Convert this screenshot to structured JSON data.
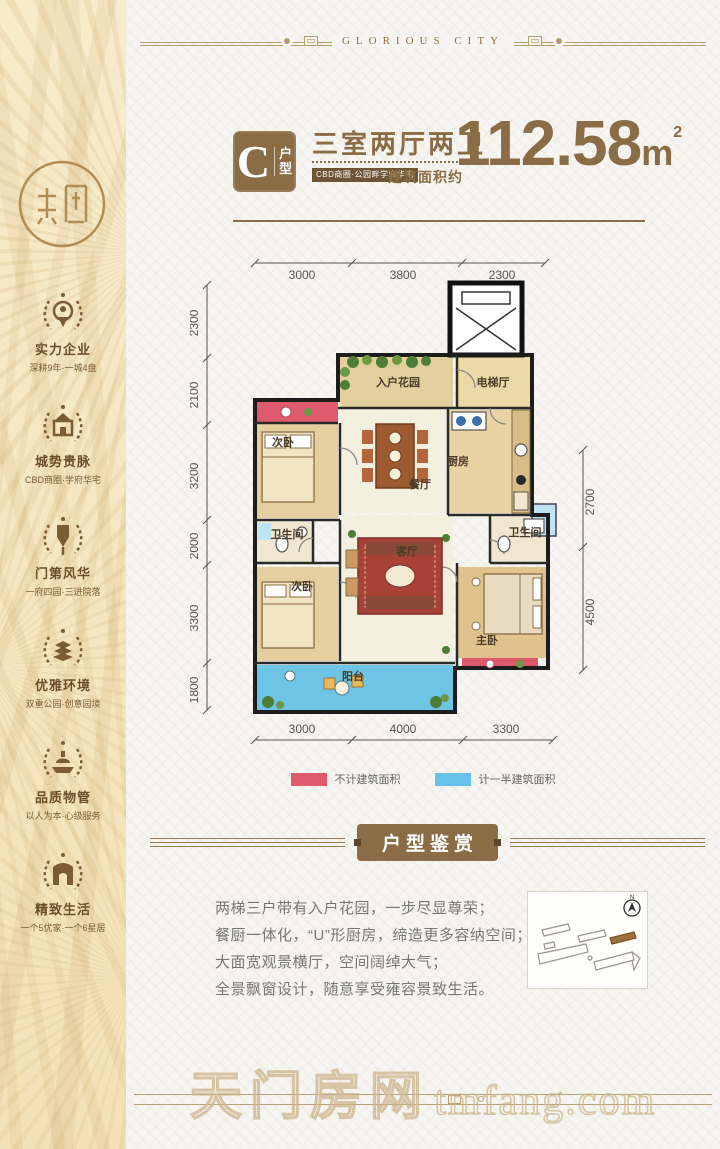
{
  "banner": {
    "text": "GLORIOUS CITY"
  },
  "sidebar": {
    "badges": [
      {
        "title": "实力企业",
        "subtitle": "深耕9年·一城4盘"
      },
      {
        "title": "城势贵脉",
        "subtitle": "CBD商圈·学府华宅"
      },
      {
        "title": "门第风华",
        "subtitle": "一府四园·三进院落"
      },
      {
        "title": "优雅环境",
        "subtitle": "双重公园·创意园境"
      },
      {
        "title": "品质物管",
        "subtitle": "以人为本·心级服务"
      },
      {
        "title": "精致生活",
        "subtitle": "一个5优家·一个6星居"
      }
    ]
  },
  "title_block": {
    "unit_letter": "C",
    "unit_label_1": "户",
    "unit_label_2": "型",
    "layout_name": "三室两厅两卫",
    "tagline": "CBD商圈·公园畔学府华宅",
    "area_prefix": "建筑面积约",
    "area_value": "112.58",
    "area_unit": "m",
    "area_exp": "2"
  },
  "floorplan": {
    "rooms": {
      "garden": "入户花园",
      "elevator_hall": "电梯厅",
      "kitchen": "厨房",
      "bedroom2": "次卧",
      "dining": "餐厅",
      "bath1": "卫生间",
      "living": "客厅",
      "bedroom3": "次卧",
      "bath2": "卫生间",
      "master": "主卧",
      "balcony": "阳台"
    },
    "dims_top": [
      "3000",
      "3800",
      "2300"
    ],
    "dims_left": [
      "2300",
      "2100",
      "3200",
      "2000",
      "3300",
      "1800"
    ],
    "dims_right": [
      "2700",
      "4500"
    ],
    "dims_bottom": [
      "3000",
      "4000",
      "3300"
    ]
  },
  "legend": {
    "red": "#e05a6d",
    "blue": "#66c2e8",
    "red_label": "不计建筑面积",
    "blue_label": "计一半建筑面积"
  },
  "section_title": "户型鉴赏",
  "description": [
    "两梯三户带有入户花园，一步尽显尊荣；",
    "餐厨一体化，“U”形厨房，缔造更多容纳空间；",
    "大面宽观景横厅，空间阔绰大气；",
    "全景飘窗设计，随意享受雍容景致生活。"
  ],
  "watermark": {
    "cn": "天门房网",
    "en": "tmfang.com"
  },
  "colors": {
    "brand_brown": "#8a6c45",
    "dark_label": "#6d5435"
  }
}
